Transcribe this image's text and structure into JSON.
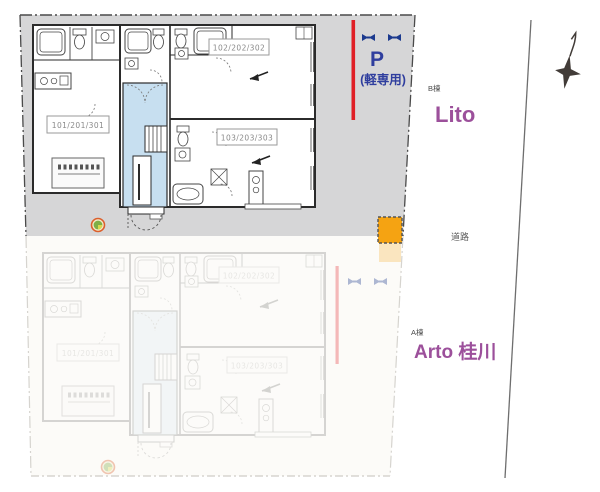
{
  "site": {
    "road": {
      "label": "道路"
    },
    "parking": {
      "symbol": "P",
      "note": "(軽専用)"
    },
    "buildings": {
      "b": {
        "tag": "B棟",
        "name": "Lito"
      },
      "a": {
        "tag": "A棟",
        "name": "Arto 桂川"
      }
    },
    "units": {
      "u101": "101/201/301",
      "u102": "102/202/302",
      "u103": "103/203/303"
    }
  },
  "icons": {
    "north_compass": "✦",
    "wheel_stopper": "⋈",
    "site_marker": "◉"
  },
  "colors": {
    "site_gray": "#d6d6d7",
    "faded_site": "#fcfbf8",
    "accent_purple": "#9c509b",
    "parking_blue": "#2f3e9e",
    "stopper_navy": "#1c3a8e",
    "marker_red": "#e01f26",
    "utility_orange": "#f5a312",
    "stair_blue": "#c7dff0"
  }
}
